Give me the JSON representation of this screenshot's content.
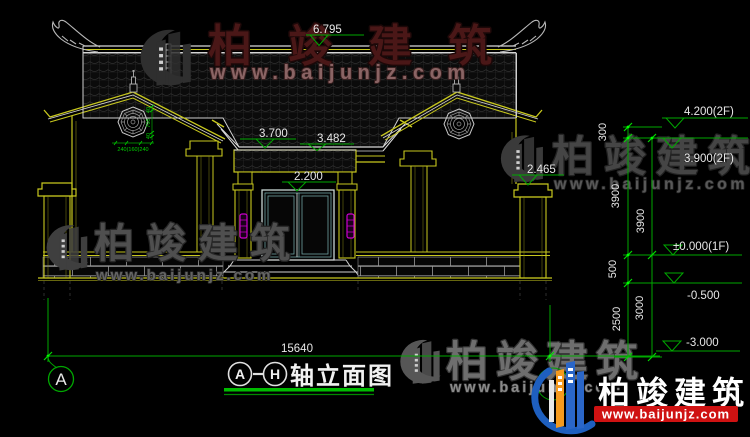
{
  "drawing": {
    "title": {
      "axis_start": "A",
      "axis_end": "H",
      "name": "轴立面图"
    },
    "axis_bubble_label": "A",
    "total_width_dim": "15640",
    "levels": {
      "ridge": "6.795",
      "center_eave": "3.700",
      "canopy": "3.482",
      "door": "2.200",
      "side_eave": "2.465",
      "roof_2f": "4.200(2F)",
      "floor_2f": "3.900(2F)",
      "floor_1f": "±0.000(1F)",
      "below_grade": "-0.500",
      "foundation": "-3.000"
    },
    "vertical_dims": {
      "parapet": "300",
      "floor2_height_a": "3900",
      "floor2_height_b": "3900",
      "plinth": "500",
      "basement_a": "2500",
      "basement_b": "3000"
    },
    "window_dims": {
      "horizontal": "240(160)240",
      "vertical_top": "40",
      "vertical_mid": "705",
      "vertical_bot": "40"
    }
  },
  "watermarks": {
    "top": {
      "brand": "柏竣建筑",
      "url": "www.baijunjz.com"
    },
    "left": {
      "brand": "柏竣建筑",
      "url": "www.baijunjz.com"
    },
    "right": {
      "brand": "柏竣建筑",
      "url": "www.baijunjz.com"
    },
    "bottom": {
      "brand": "柏竣建筑",
      "url": "www.baijunjz.com"
    }
  },
  "logo": {
    "brand": "柏竣建筑",
    "url": "www.baijunjz.com"
  },
  "colors": {
    "background": "#000000",
    "cad_yellow": "#c8c81e",
    "cad_white": "#d8d8d8",
    "dim_green": "#00a800",
    "lamp_magenta": "#cc00cc",
    "logo_blue": "#2a66c8",
    "logo_orange": "#f59a1e",
    "logo_red": "#cf1212"
  }
}
